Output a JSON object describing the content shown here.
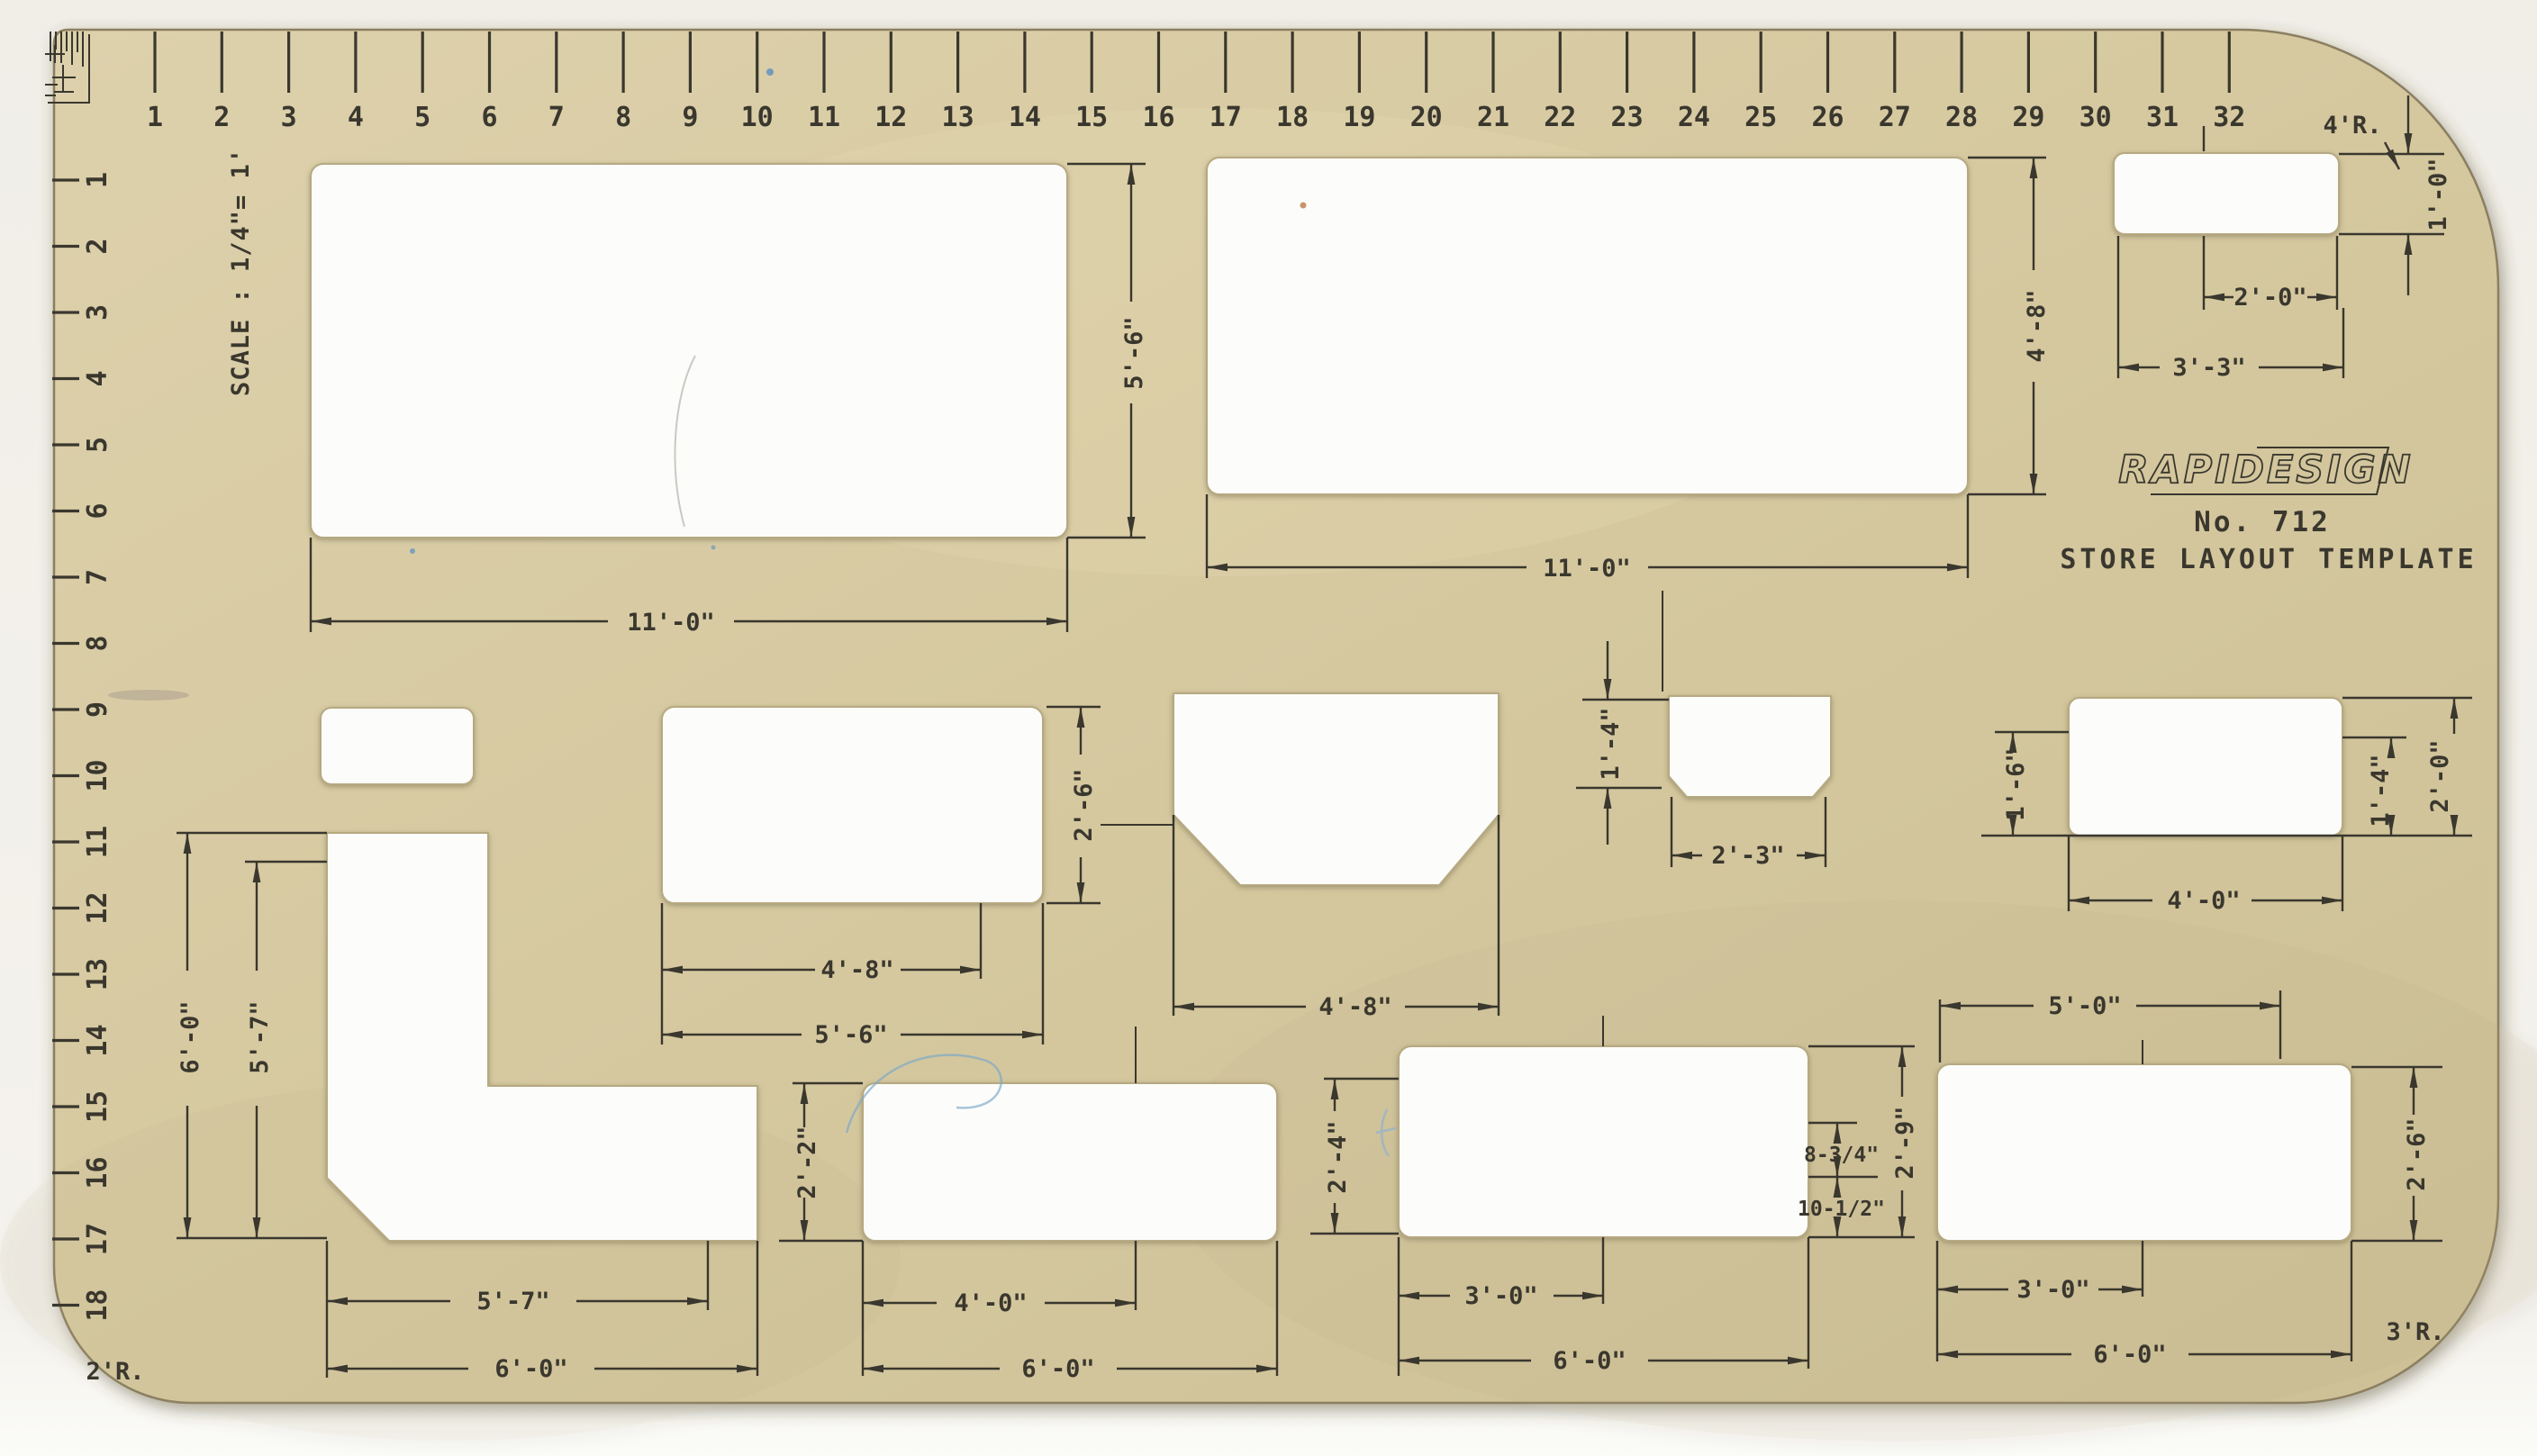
{
  "title": "RapiDesign No. 712 Store Layout Template (scanned drafting stencil)",
  "brand": {
    "logo": "RAPIDESIGN",
    "model": "No. 712",
    "name": "STORE LAYOUT TEMPLATE"
  },
  "scale_note": "SCALE : 1/4\"= 1'",
  "top_ruler": {
    "numbers": [
      "1",
      "2",
      "3",
      "4",
      "5",
      "6",
      "7",
      "8",
      "9",
      "10",
      "11",
      "12",
      "13",
      "14",
      "15",
      "16",
      "17",
      "18",
      "19",
      "20",
      "21",
      "22",
      "23",
      "24",
      "25",
      "26",
      "27",
      "28",
      "29",
      "30",
      "31",
      "32"
    ]
  },
  "left_ruler": {
    "numbers": [
      "1",
      "2",
      "3",
      "4",
      "5",
      "6",
      "7",
      "8",
      "9",
      "10",
      "11",
      "12",
      "13",
      "14",
      "15",
      "16",
      "17",
      "18"
    ]
  },
  "corner_radii": {
    "top_right": "4'R.",
    "bottom_left": "2'R.",
    "bottom_right": "3'R."
  },
  "dims": {
    "r1_h": "5'-6\"",
    "r1_w": "11'-0\"",
    "r2_h": "4'-8\"",
    "r2_w": "11'-0\"",
    "r3_h": "1'-0\"",
    "r3_inner": "2'-0\"",
    "r3_w": "3'-3\"",
    "r5_h": "2'-6\"",
    "r5_inner": "4'-8\"",
    "r5_w": "5'-6\"",
    "tub_w": "4'-8\"",
    "stub_h": "1'-4\"",
    "stub_w": "2'-3\"",
    "r8_left": "1'-6\"",
    "r8_inner": "1'-4\"",
    "r8_right": "2'-0\"",
    "r8_w": "4'-0\"",
    "l_outer_h": "6'-0\"",
    "l_inner_h": "5'-7\"",
    "l_inner_w": "5'-7\"",
    "l_outer_w": "6'-0\"",
    "r10_h": "2'-2\"",
    "r10_inner": "4'-0\"",
    "r10_w": "6'-0\"",
    "r11_left": "2'-4\"",
    "r11_seg_top": "8-3/4\"",
    "r11_seg_bottom": "10-1/2\"",
    "r11_right": "2'-9\"",
    "r11_inner": "3'-0\"",
    "r11_w": "6'-0\"",
    "r12_top": "5'-0\"",
    "r12_right": "2'-6\"",
    "r12_inner": "3'-0\"",
    "r12_w": "6'-0\""
  },
  "colors": {
    "sheet_tan": "#d6c9a0",
    "ink": "#3a372e",
    "cutout_white": "#fcfcfa",
    "scan_background": "#f2f0ea"
  }
}
